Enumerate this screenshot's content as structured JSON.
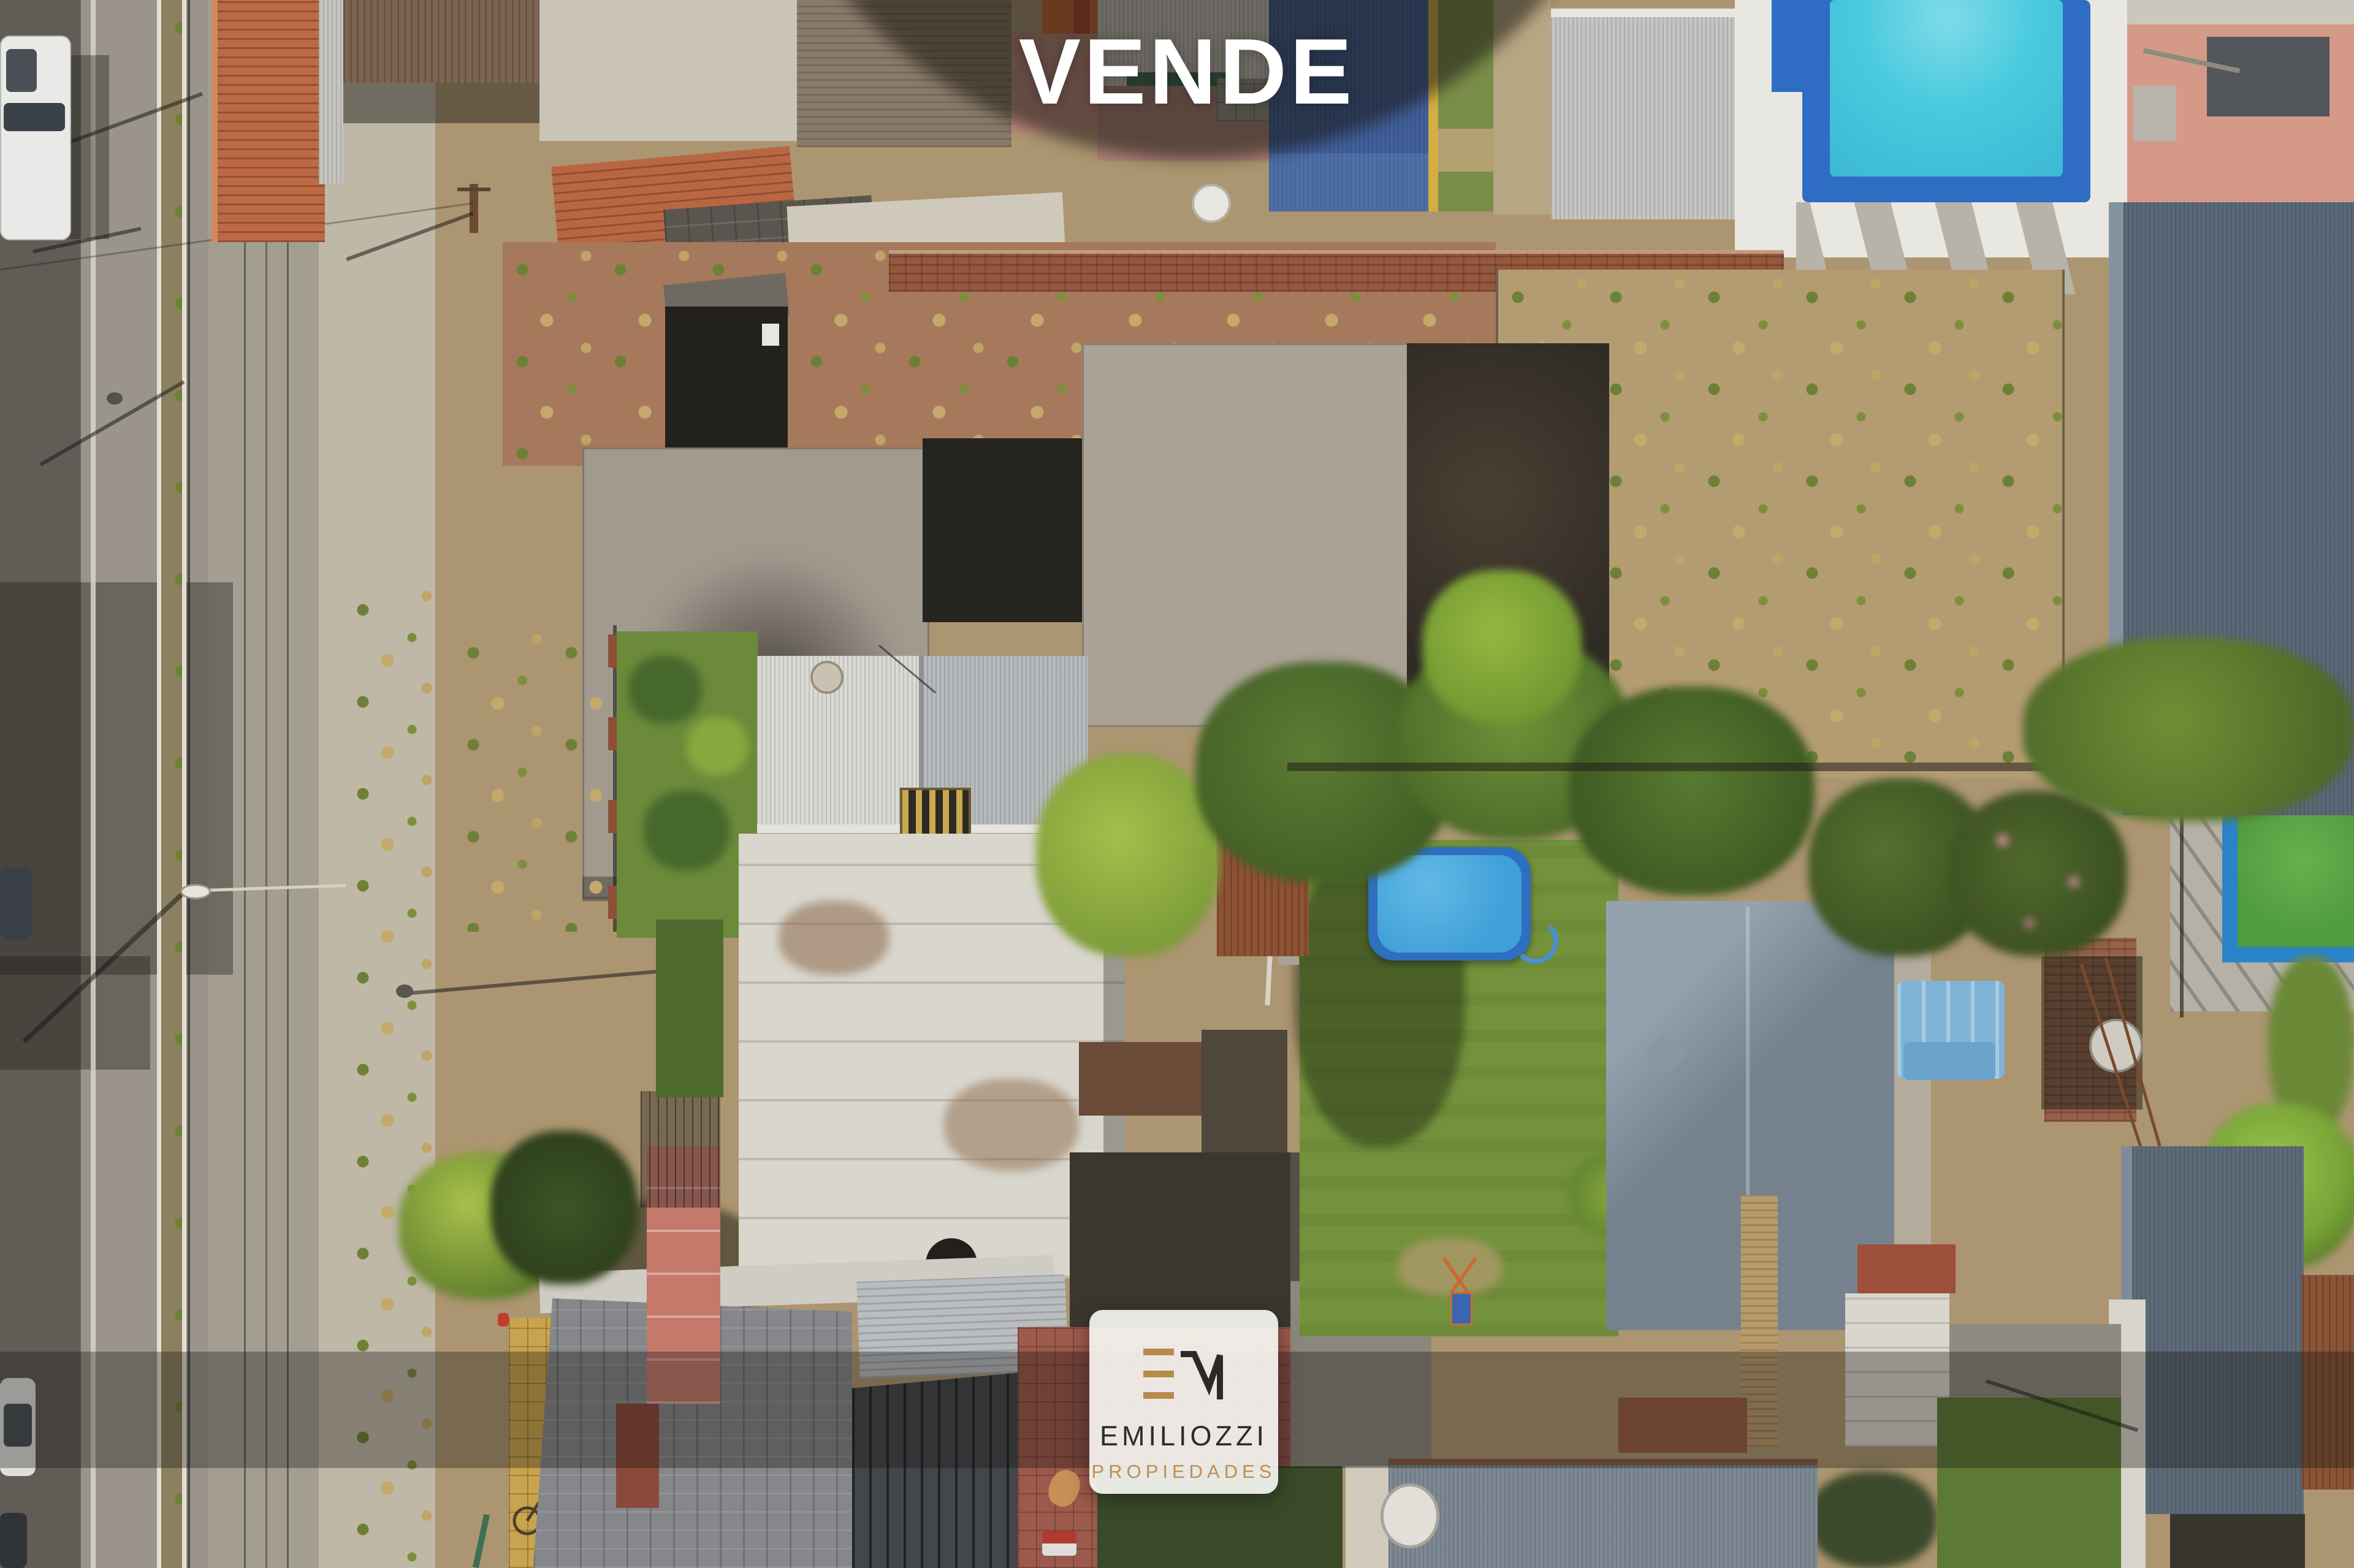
{
  "overlay": {
    "headline": "VENDE",
    "brand": {
      "monogram_letters": "EM",
      "name": "EMILIOZZI",
      "tagline": "PROPIEDADES",
      "colors": {
        "gold": "#B98B4C",
        "ink": "#2E2C29",
        "card_bg": "#FAF9F6"
      }
    },
    "effects": {
      "headline_color": "#FFFFFF",
      "vignette_color": "rgba(23,20,16,0.54)",
      "bottom_band_color": "rgba(17,14,11,0.33)"
    }
  },
  "scene": {
    "type": "aerial-drone-photograph",
    "features": [
      "avenue-with-median",
      "parked-vehicles",
      "street-lamps",
      "street-tree",
      "clay-tile-roofs",
      "corrugated-metal-roofs",
      "vacant-lot-for-sale",
      "unfinished-concrete-slab",
      "burned-shed",
      "backyard-lawn",
      "above-ground-pool",
      "in-ground-pool-blue",
      "lap-pool-green-water",
      "tree-canopies",
      "brick-barbecue",
      "satellite-dishes",
      "yellow-tactile-paving"
    ],
    "palette": {
      "asphalt": "#9A948A",
      "sidewalk": "#C0B8A7",
      "dirt_lot": "#B49C72",
      "brick_dirt": "#A6795C",
      "concrete_slab": "#A29A8F",
      "lawn": "#74923C",
      "tree_dark": "#4B6628",
      "tree_bright": "#93B83F",
      "navy_roof": "#41609B",
      "pool_border": "#2F6DC4",
      "pool_water": "#49CADE",
      "green_pool_water": "#4F9B40",
      "slate_roof": "#5A6877",
      "tile_roof_orange": "#BC6A44",
      "terracotta": "#9B5A4C"
    }
  }
}
